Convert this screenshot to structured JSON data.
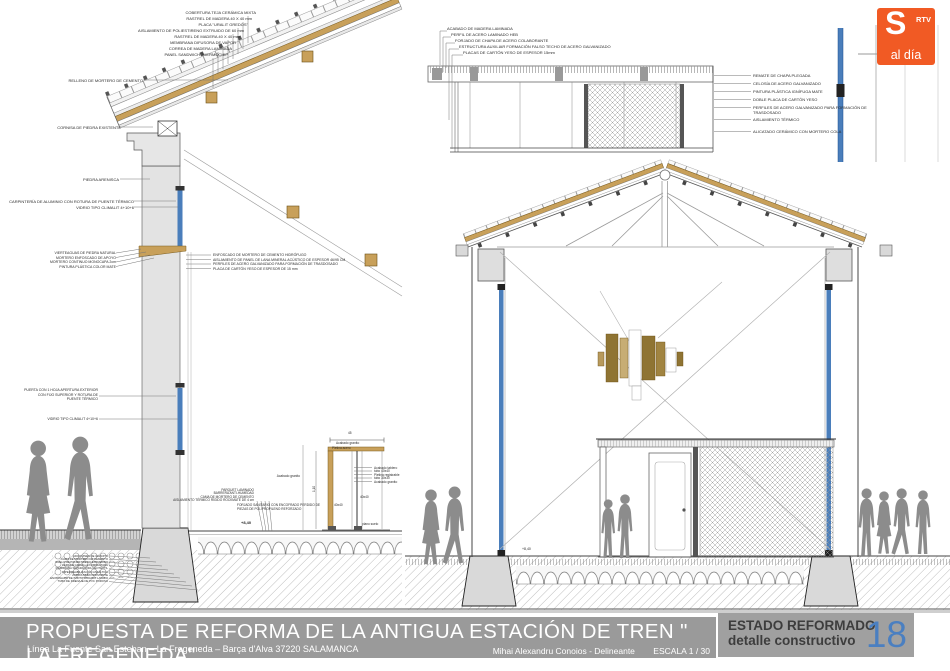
{
  "logo": {
    "s": "S",
    "rtv": "RTV",
    "tagline": "al día",
    "color": "#f15a24"
  },
  "title_block": {
    "title": "PROPUESTA DE REFORMA DE LA ANTIGUA ESTACIÓN DE TREN \" LA FREGENEDA\"",
    "subtitle": "Línea La Fuente San Esteban – La Fregeneda – Barça d'Alva  37220 SALAMANCA",
    "author": "Mihai Alexandru Conoios - Delineante",
    "scale": "ESCALA 1 / 30",
    "state_line1": "ESTADO REFORMADO",
    "state_line2": "detalle constructivo",
    "sheet_number": "18"
  },
  "left_detail": {
    "roof_labels": [
      "COBERTURA TEJA CERÁMICA MIXTA",
      "RASTREL DE MADERA 40 X 40 mm",
      "PLACA \"URALIT GREDOS\"",
      "AISLAMIENTO DE POLIESTIRENO EXTRUIDO DE 60 mm",
      "RASTREL DE MADERA 40 X 40 mm",
      "MEMBRANA DIFUSORA DE VAPOR",
      "CORREA DE MADERA LAMINADA",
      "PANEL SANDWICH THERMOCHIP"
    ],
    "relleno_label": "RELLENO DE MORTERO DE CEMENTO",
    "cornisa_label": "CORNISA DE PIEDRA EXISTENTE",
    "piedra_label": "PIEDRA ARENISCA",
    "carpinteria_label": "CARPINTERÍA DE ALUMINIO CON ROTURA DE PUENTE TÉRMICO",
    "vidrio_label": "VIDRIO TIPO CLIMALIT 4+10+6",
    "sill_labels": [
      "VIERTEAGUAS DE PIEDRA NATURAL",
      "MORTERO ENFOSCADO DE APOYO",
      "MORTERO CONTINUO MONOCAPA 2cm",
      "PINTURA PLÁSTICA COLOR MATE"
    ],
    "trasdosado_labels": [
      "ENFOSCADO DE MORTERO DE CEMENTO HIDRÓFUGO",
      "AISLAMIENTO DE PANEL DE LANA MINERAL ACÚSTICO DE ESPESOR 46/95 CM",
      "PERFILES DE ACERO GALVANIZADO PARA FORMACIÓN DE TRASDOSADO",
      "PLACA DE CARTÓN YESO DE ESPESOR DE 15 mm"
    ],
    "puerta_label": "PUERTA CON 1 HOJA APERTURA EXTERIOR CON FIJO SUPERIOR Y ROTURA DE PUENTE TÉRMICO",
    "vidrio2_label": "VIDRIO TIPO CLIMALIT 4+10+6",
    "floor_labels": [
      "PARQUET LAMINADO",
      "BARRERA ANTI-HUMEDAD",
      "CAMA DE MORTERO DE CEMENTO",
      "AISLAMIENTO TÉRMICO RÍGIDO ROCKMATE DE 4 cm"
    ],
    "forjado_label": "FORJADO SANITARIO CON ENCOFRADO PERDIDO DE PIEZAS DE POLIPROPILENO REFORZADO",
    "level_mark": "+8,40",
    "foundation_labels": [
      "ADOQUINES DE GRANITO",
      "CAMA DE MORTERO DE CEMENTO",
      "SUELO DE POLIESTIRENO EXPANDIDO",
      "CAPA DE GRAVILLA COMPACTADA",
      "MEMBRANA SEPARADORA GEOTEXTIL",
      "IMPERMEABILIZACIÓN ASFÁLTICA",
      "ZAPATA MURO EXISTENTE",
      "ENCACHADO DE CANTO RODADO LAVADO",
      "TUBO DE DRENAJE DE PVC POROSO"
    ]
  },
  "bench_detail": {
    "dim_width": "45",
    "dim_height": "1,10",
    "top_label1": "Acabado granito",
    "top_label2": "Pletina acero",
    "side_labels": [
      "Acabado tablero",
      "tubo 40x40",
      "Pletina registrable",
      "tubo 30x30",
      "Acabado granito"
    ],
    "left_label": "Acabado granito",
    "tube_label1": "40x40",
    "tube_label2": "40x40",
    "floor_label": "plano suelo"
  },
  "ceiling_detail": {
    "labels": [
      "ACABADO DE MADERA LAMINADA",
      "PERFIL DE ACERO LAMINADO HEB",
      "FORJADO DE CHAPA DE ACERO COLABORANTE",
      "ESTRUCTURA AUXILIAR FORMACIÓN FALSO TECHO DE ACERO GALVANIZADO",
      "PLACAS DE CARTÓN YESO DE ESPESOR 15mm"
    ]
  },
  "wall_detail": {
    "labels": [
      "REMATE DE CHAPA PLEGADA",
      "CELOSÍA DE ACERO GALVANIZADO",
      "PINTURA PLÁSTICA IGNÍFUGA MATE",
      "DOBLE PLACA DE CARTÓN YESO",
      "PERFILES DE ACERO GALVANIZADO PARA FORMACIÓN DE TRASDOSADO",
      "AISLAMIENTO TÉRMICO",
      "ALICATADO CERÁMICO CON MORTERO COLA"
    ]
  },
  "section": {
    "level_mark": "+8,40"
  },
  "colors": {
    "wood": "#c8a05a",
    "wood_dark": "#8f7433",
    "glass": "#4a7ebb",
    "bar_gray": "#9a9a9a",
    "sheet_blue": "#4a7fc1",
    "logo_orange": "#f15a24",
    "silhouette": "#8c8c8c",
    "wall_gray": "#dcdcdc"
  }
}
